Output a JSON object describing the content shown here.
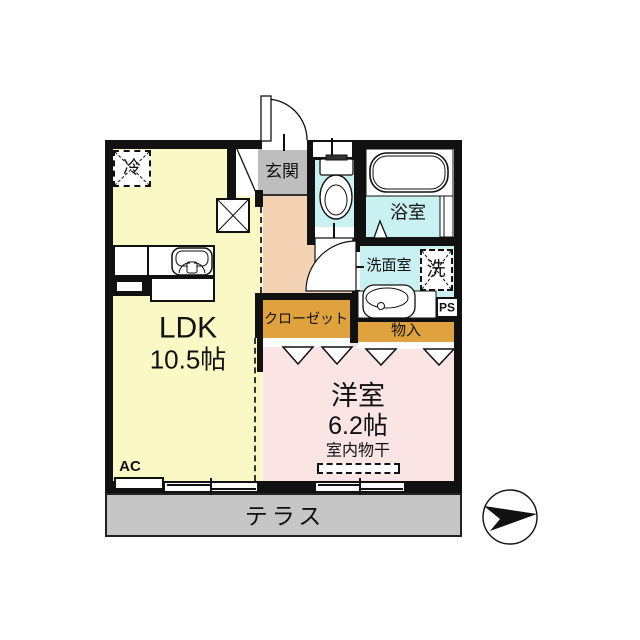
{
  "plan": {
    "rooms": {
      "ldk": {
        "label": "LDK",
        "size": "10.5帖"
      },
      "western": {
        "label": "洋室",
        "size": "6.2帖",
        "feature": "室内物干"
      },
      "entrance": {
        "label": "玄関"
      },
      "bath": {
        "label": "浴室"
      },
      "washroom": {
        "label": "洗面室"
      },
      "closet": {
        "label": "クローゼット"
      },
      "storage": {
        "label": "物入"
      },
      "terrace": {
        "label": "テラス"
      }
    },
    "fixtures": {
      "refrigerator": "冷",
      "washer": "洗",
      "air_conditioner": "AC",
      "pipe_space": "PS"
    }
  },
  "colors": {
    "ldk": "#FAF9C6",
    "hall": "#F4D2B4",
    "western": "#FAE4E4",
    "wet": "#C9F1F1",
    "closet": "#DFA23F",
    "entrance": "#BEBEBE",
    "terrace": "#C6C6C6",
    "wall": "#111111"
  }
}
